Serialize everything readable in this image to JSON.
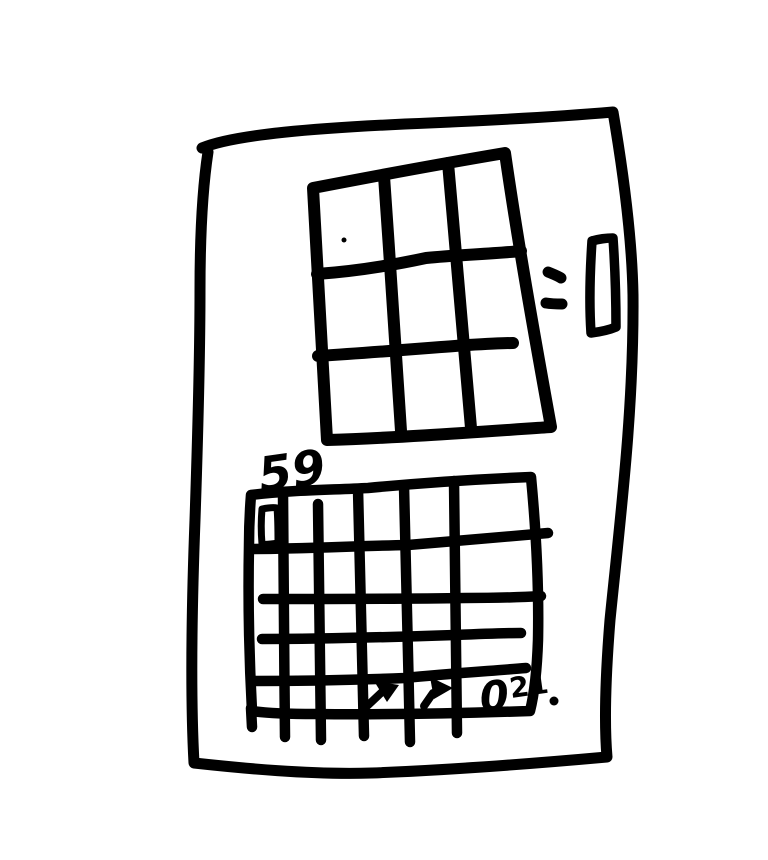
{
  "page": {
    "background": "#ffffff",
    "ink": "#000000",
    "kind": "hand-drawn wireframe sketch"
  },
  "labels": {
    "bottom_grid_title": "59",
    "zero_value": "0",
    "zero_superscript": "21"
  },
  "structure": {
    "top_grid": {
      "rows": 3,
      "columns": 3
    },
    "bottom_grid": {
      "rows": 5,
      "columns": 6
    }
  },
  "icons": {
    "cursor_arrow_left": "arrow-pointer-up-right",
    "cursor_arrow_right": "arrow-pointer-right",
    "cell_marker": "small-rectangle-outline",
    "side_slider": "vertical-scrollbar-rectangle",
    "side_dashes": "double-dash-marks",
    "top_grid_dot": "tiny-ink-dot",
    "stray_dot": "period-dot"
  }
}
